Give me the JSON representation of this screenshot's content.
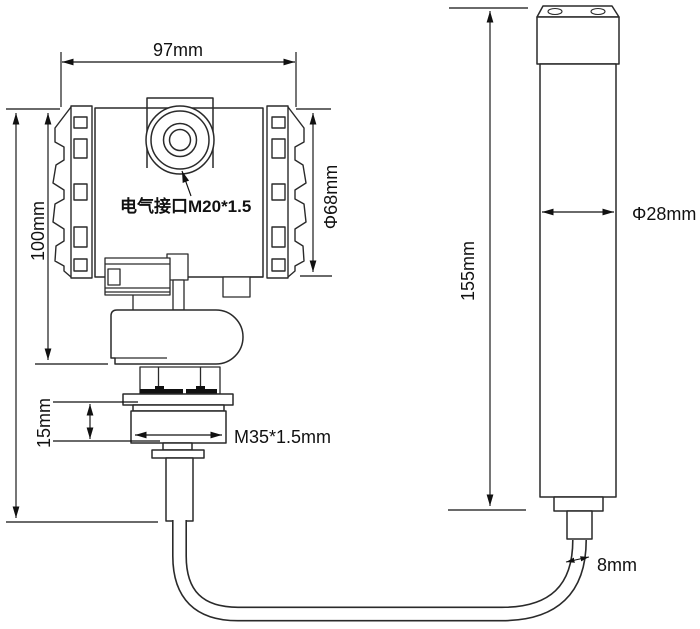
{
  "transmitter": {
    "width_label": "97mm",
    "height_label": "100mm",
    "electrical_port_label": "电气接口M20*1.5",
    "housing_diameter_label": "Φ68mm",
    "thread_length_label": "15mm",
    "thread_spec_label": "M35*1.5mm"
  },
  "probe": {
    "length_label": "155mm",
    "diameter_label": "Φ28mm",
    "cable_diameter_label": "8mm"
  },
  "colors": {
    "line": "#2a2a2a",
    "dimension": "#111111",
    "text": "#111111",
    "background": "#ffffff"
  }
}
